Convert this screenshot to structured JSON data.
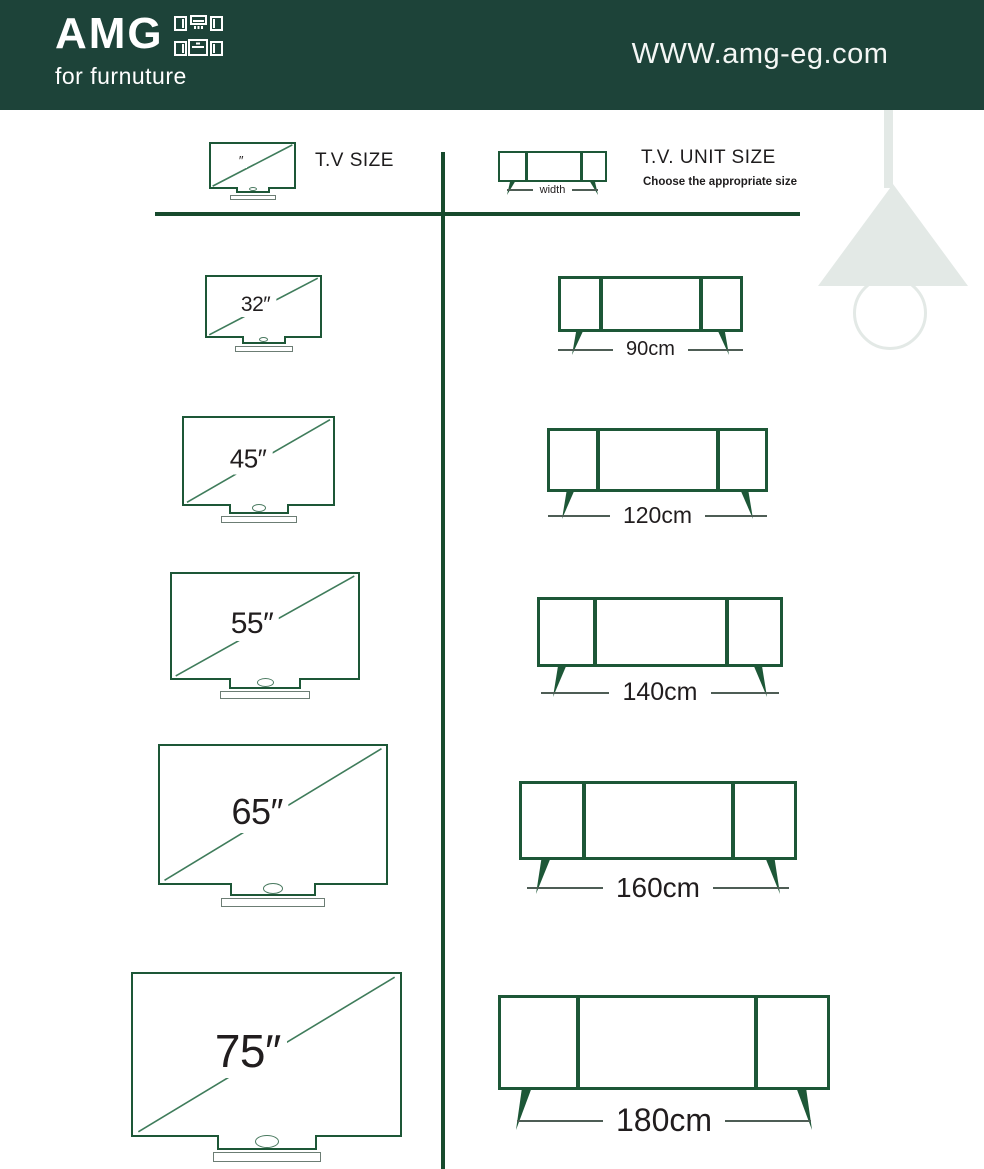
{
  "header": {
    "logo": "AMG",
    "tagline": "for furnuture",
    "website": "WWW.amg-eg.com"
  },
  "legend": {
    "tv_title": "T.V SIZE",
    "tv_icon_mark": "″",
    "unit_title": "T.V. UNIT SIZE",
    "unit_subtitle": "Choose the appropriate size",
    "width_label": "width"
  },
  "rows": [
    {
      "tv_size": "32″",
      "unit_width": "90cm"
    },
    {
      "tv_size": "45″",
      "unit_width": "120cm"
    },
    {
      "tv_size": "55″",
      "unit_width": "140cm"
    },
    {
      "tv_size": "65″",
      "unit_width": "160cm"
    },
    {
      "tv_size": "75″",
      "unit_width": "180cm"
    }
  ],
  "colors": {
    "header_bg": "#1d4339",
    "line_green": "#1d5737",
    "lamp_gray": "#e3e9e6",
    "text_dark": "#211d1e"
  }
}
